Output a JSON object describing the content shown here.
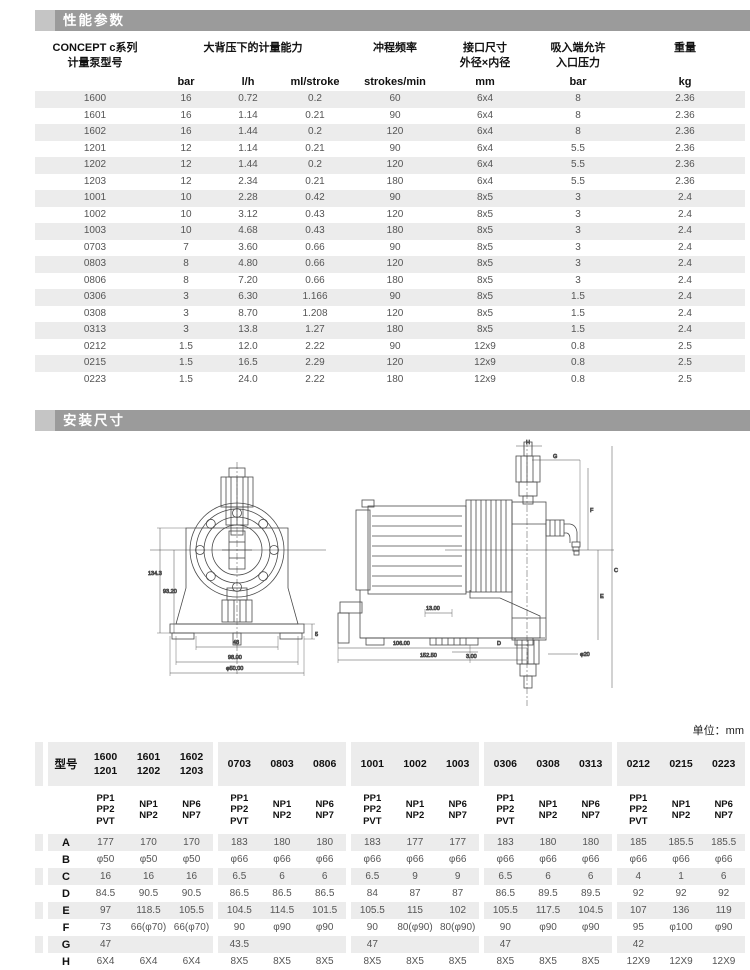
{
  "colors": {
    "section_bar": "#9b9b9b",
    "section_bar_tab": "#c5c5c5",
    "row_stripe": "#ececec",
    "data_text": "#555555"
  },
  "sections": {
    "performance_title": "性能参数",
    "installation_title": "安装尺寸"
  },
  "unit_note": "单位：mm",
  "perf_table": {
    "headers": {
      "model_line1": "CONCEPT c系列",
      "model_line2": "计量泵型号",
      "capacity": "大背压下的计量能力",
      "stroke_frequency": "冲程频率",
      "port_line1": "接口尺寸",
      "port_line2": "外径×内径",
      "suction_line1": "吸入端允许",
      "suction_line2": "入口压力",
      "weight": "重量",
      "units": [
        "bar",
        "l/h",
        "ml/stroke",
        "strokes/min",
        "mm",
        "bar",
        "kg"
      ]
    },
    "rows": [
      [
        "1600",
        "16",
        "0.72",
        "0.2",
        "60",
        "6x4",
        "8",
        "2.36"
      ],
      [
        "1601",
        "16",
        "1.14",
        "0.21",
        "90",
        "6x4",
        "8",
        "2.36"
      ],
      [
        "1602",
        "16",
        "1.44",
        "0.2",
        "120",
        "6x4",
        "8",
        "2.36"
      ],
      [
        "1201",
        "12",
        "1.14",
        "0.21",
        "90",
        "6x4",
        "5.5",
        "2.36"
      ],
      [
        "1202",
        "12",
        "1.44",
        "0.2",
        "120",
        "6x4",
        "5.5",
        "2.36"
      ],
      [
        "1203",
        "12",
        "2.34",
        "0.21",
        "180",
        "6x4",
        "5.5",
        "2.36"
      ],
      [
        "1001",
        "10",
        "2.28",
        "0.42",
        "90",
        "8x5",
        "3",
        "2.4"
      ],
      [
        "1002",
        "10",
        "3.12",
        "0.43",
        "120",
        "8x5",
        "3",
        "2.4"
      ],
      [
        "1003",
        "10",
        "4.68",
        "0.43",
        "180",
        "8x5",
        "3",
        "2.4"
      ],
      [
        "0703",
        "7",
        "3.60",
        "0.66",
        "90",
        "8x5",
        "3",
        "2.4"
      ],
      [
        "0803",
        "8",
        "4.80",
        "0.66",
        "120",
        "8x5",
        "3",
        "2.4"
      ],
      [
        "0806",
        "8",
        "7.20",
        "0.66",
        "180",
        "8x5",
        "3",
        "2.4"
      ],
      [
        "0306",
        "3",
        "6.30",
        "1.166",
        "90",
        "8x5",
        "1.5",
        "2.4"
      ],
      [
        "0308",
        "3",
        "8.70",
        "1.208",
        "120",
        "8x5",
        "1.5",
        "2.4"
      ],
      [
        "0313",
        "3",
        "13.8",
        "1.27",
        "180",
        "8x5",
        "1.5",
        "2.4"
      ],
      [
        "0212",
        "1.5",
        "12.0",
        "2.22",
        "90",
        "12x9",
        "0.8",
        "2.5"
      ],
      [
        "0215",
        "1.5",
        "16.5",
        "2.29",
        "120",
        "12x9",
        "0.8",
        "2.5"
      ],
      [
        "0223",
        "1.5",
        "24.0",
        "2.22",
        "180",
        "12x9",
        "0.8",
        "2.5"
      ]
    ]
  },
  "dim_table": {
    "model_label": "型号",
    "model_groups": [
      [
        [
          "1600",
          "1201"
        ],
        [
          "1601",
          "1202"
        ],
        [
          "1602",
          "1203"
        ]
      ],
      [
        [
          "0703"
        ],
        [
          "0803"
        ],
        [
          "0806"
        ]
      ],
      [
        [
          "1001"
        ],
        [
          "1002"
        ],
        [
          "1003"
        ]
      ],
      [
        [
          "0306"
        ],
        [
          "0308"
        ],
        [
          "0313"
        ]
      ],
      [
        [
          "0212"
        ],
        [
          "0215"
        ],
        [
          "0223"
        ]
      ]
    ],
    "materials": [
      [
        "PP1",
        "PP2",
        "PVT"
      ],
      [
        "NP1",
        "NP2"
      ],
      [
        "NP6",
        "NP7"
      ]
    ],
    "rows": [
      {
        "label": "A",
        "values": [
          "177",
          "170",
          "170",
          "183",
          "180",
          "180",
          "183",
          "177",
          "177",
          "183",
          "180",
          "180",
          "185",
          "185.5",
          "185.5"
        ]
      },
      {
        "label": "B",
        "values": [
          "φ50",
          "φ50",
          "φ50",
          "φ66",
          "φ66",
          "φ66",
          "φ66",
          "φ66",
          "φ66",
          "φ66",
          "φ66",
          "φ66",
          "φ66",
          "φ66",
          "φ66"
        ]
      },
      {
        "label": "C",
        "values": [
          "16",
          "16",
          "16",
          "6.5",
          "6",
          "6",
          "6.5",
          "9",
          "9",
          "6.5",
          "6",
          "6",
          "4",
          "1",
          "6"
        ]
      },
      {
        "label": "D",
        "values": [
          "84.5",
          "90.5",
          "90.5",
          "86.5",
          "86.5",
          "86.5",
          "84",
          "87",
          "87",
          "86.5",
          "89.5",
          "89.5",
          "92",
          "92",
          "92"
        ]
      },
      {
        "label": "E",
        "values": [
          "97",
          "118.5",
          "105.5",
          "104.5",
          "114.5",
          "101.5",
          "105.5",
          "115",
          "102",
          "105.5",
          "117.5",
          "104.5",
          "107",
          "136",
          "119"
        ]
      },
      {
        "label": "F",
        "values": [
          "73",
          "66(φ70)",
          "66(φ70)",
          "90",
          "φ90",
          "φ90",
          "90",
          "80(φ90)",
          "80(φ90)",
          "90",
          "φ90",
          "φ90",
          "95",
          "φ100",
          "φ90"
        ]
      },
      {
        "label": "G",
        "values": [
          "47",
          "",
          "",
          "43.5",
          "",
          "",
          "47",
          "",
          "",
          "47",
          "",
          "",
          "42",
          "",
          ""
        ]
      },
      {
        "label": "H",
        "values": [
          "6X4",
          "6X4",
          "6X4",
          "8X5",
          "8X5",
          "8X5",
          "8X5",
          "8X5",
          "8X5",
          "8X5",
          "8X5",
          "8X5",
          "12X9",
          "12X9",
          "12X9"
        ]
      }
    ]
  },
  "drawing": {
    "front_dims": {
      "height_total": "134.3",
      "height_center": "93.20",
      "width_inner": "48",
      "width_base": "98.00",
      "width_overall": "φ50.00",
      "foot": "5"
    },
    "side_dims": {
      "h": "H",
      "g": "G",
      "f": "F",
      "e": "E",
      "c": "C",
      "d": "D",
      "slot": "13.00",
      "foot": "3.00",
      "base_len": "106.00",
      "overall_len": "152.50",
      "port": "φ20"
    }
  }
}
